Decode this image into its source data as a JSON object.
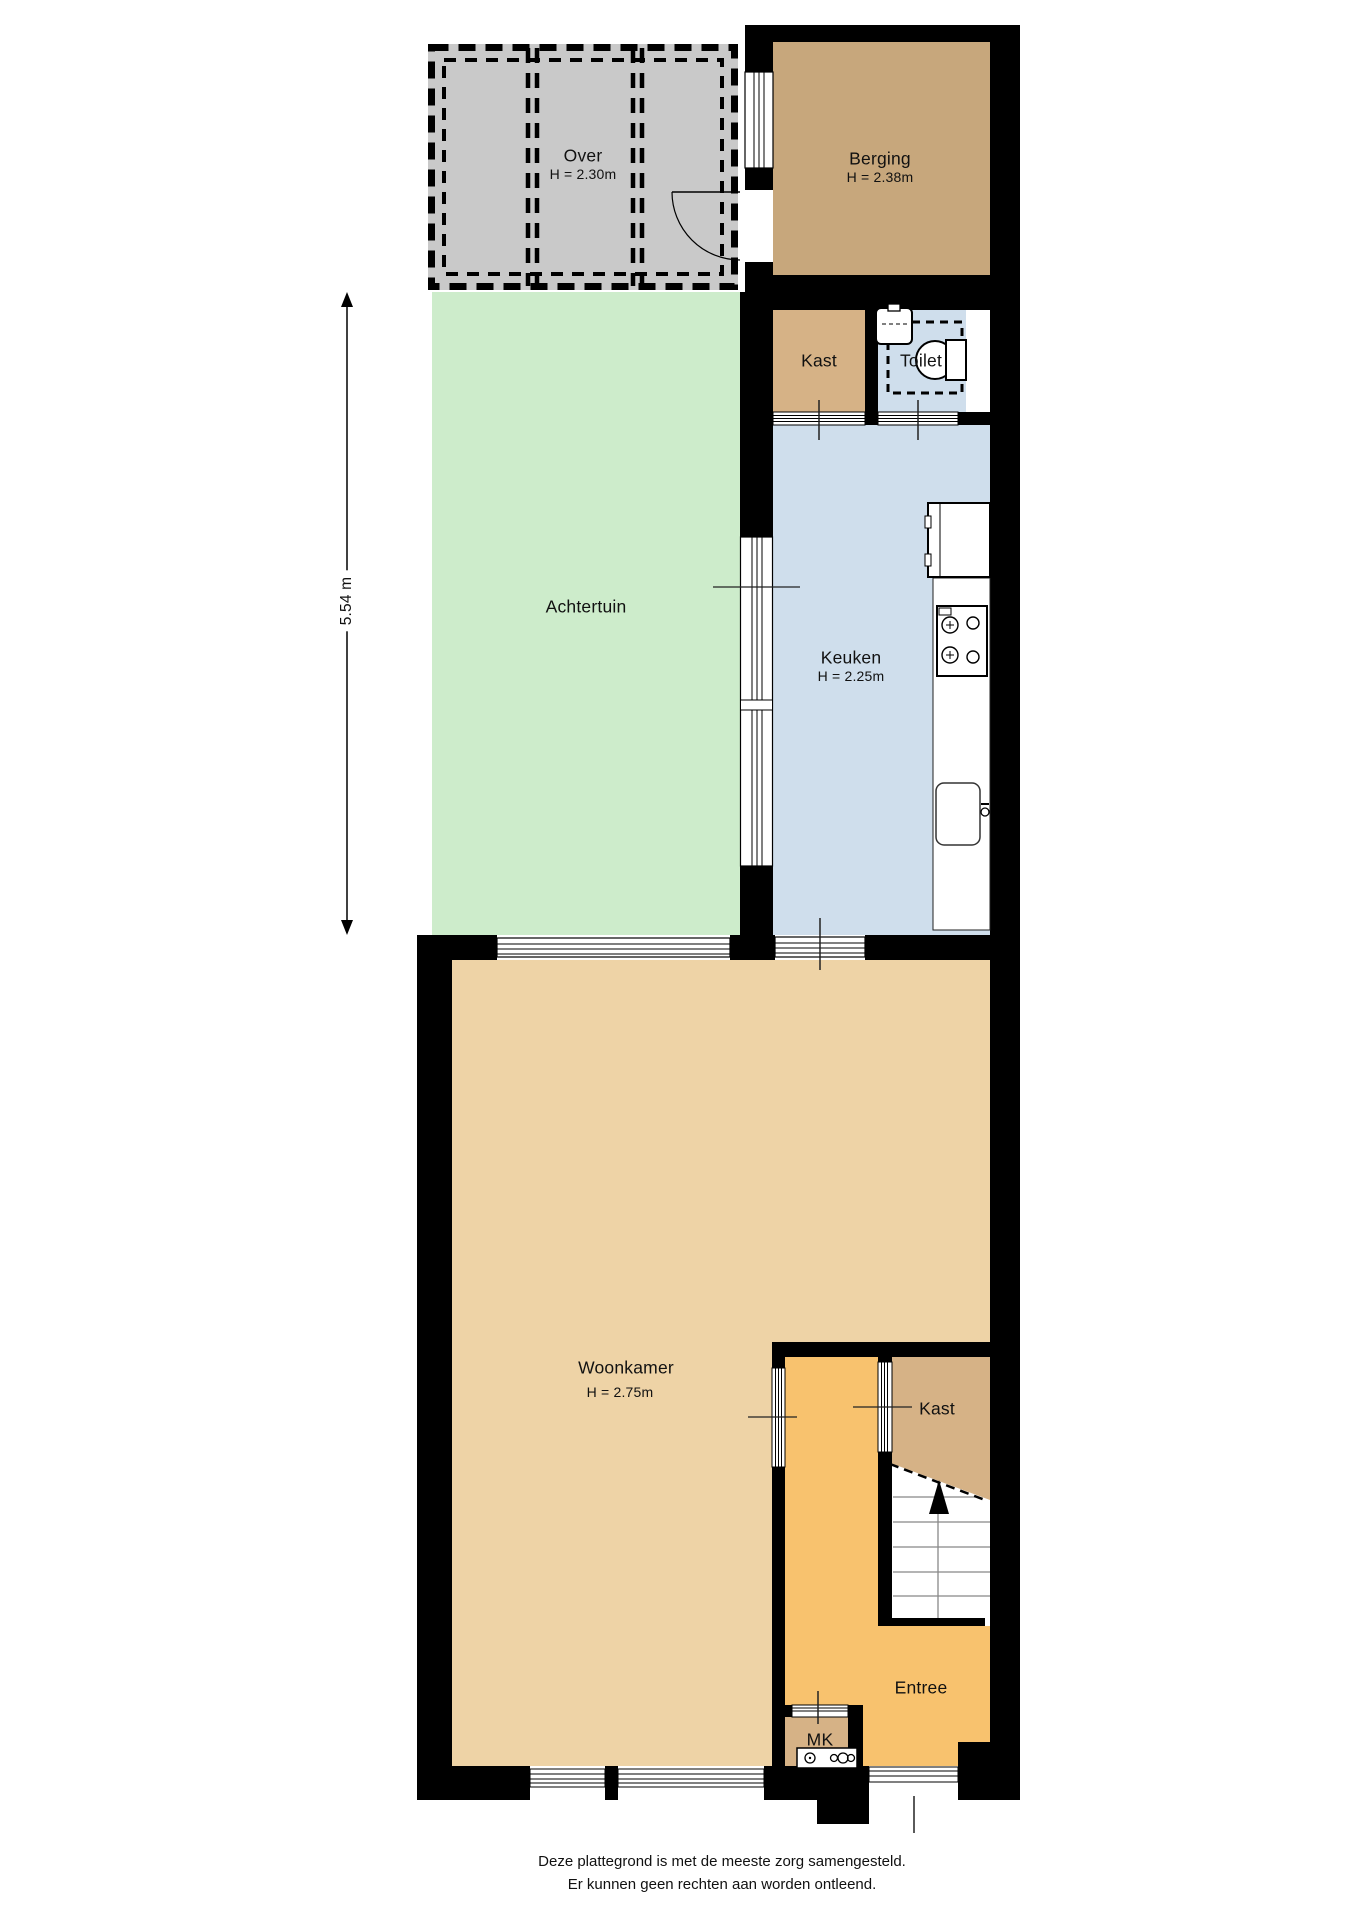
{
  "colors": {
    "wall": "#000000",
    "over": "#c9c9c9",
    "berging": "#c7a77c",
    "kast": "#d6b286",
    "garden": "#cdeccb",
    "water": "#cfdeec",
    "woonkamer": "#eed3a6",
    "entree": "#f8c26e",
    "white": "#ffffff"
  },
  "rooms": {
    "over": {
      "name": "Over",
      "height": "H = 2.30m"
    },
    "berging": {
      "name": "Berging",
      "height": "H = 2.38m"
    },
    "kast_top": {
      "name": "Kast"
    },
    "toilet": {
      "name": "Toilet"
    },
    "achtertuin": {
      "name": "Achtertuin"
    },
    "keuken": {
      "name": "Keuken",
      "height": "H = 2.25m"
    },
    "woonkamer": {
      "name": "Woonkamer",
      "height": "H = 2.75m"
    },
    "kast_lower": {
      "name": "Kast"
    },
    "entree": {
      "name": "Entree"
    },
    "mk": {
      "name": "MK"
    }
  },
  "dimension": {
    "garden_depth": "5.54 m"
  },
  "footer": {
    "line1": "Deze plattegrond is met de meeste zorg samengesteld.",
    "line2": "Er kunnen geen rechten aan worden ontleend."
  }
}
